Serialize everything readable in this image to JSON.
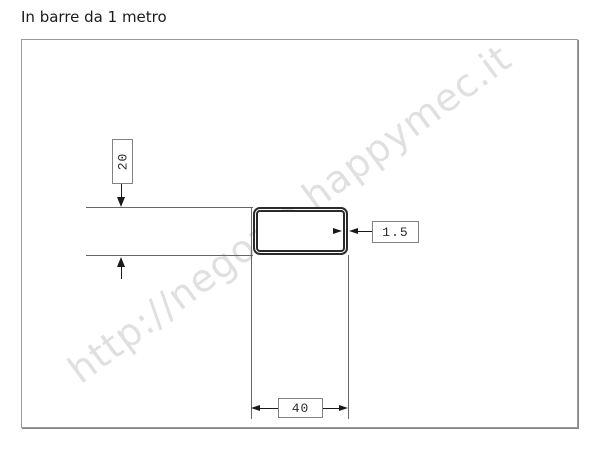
{
  "title": "In barre da 1 metro",
  "watermark": {
    "text": "http://negozio.happymec.it",
    "color": "#e0e0e0"
  },
  "drawing": {
    "type": "technical-cross-section",
    "subject": "rectangular-tube-profile",
    "dim_height": {
      "value": "20",
      "orientation": "vertical"
    },
    "dim_thickness": {
      "value": "1.5",
      "orientation": "horizontal"
    },
    "dim_width": {
      "value": "40",
      "orientation": "horizontal"
    },
    "colors": {
      "frame_border": "#9a9a9a",
      "extension_line": "#666666",
      "arrow": "#1a1a1a",
      "tube_outline": "#2a2a2a",
      "label_border": "#828282",
      "label_text": "#2b2b2b",
      "watermark": "#e0e0e0"
    }
  }
}
